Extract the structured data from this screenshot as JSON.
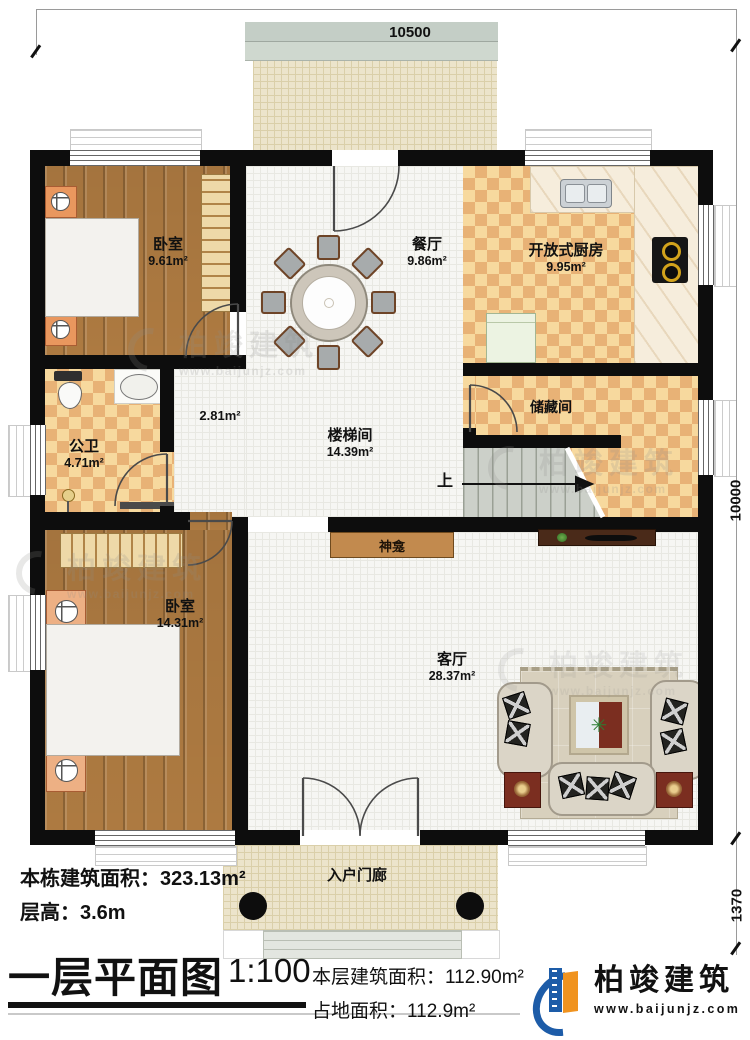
{
  "dimensions": {
    "top": "10500",
    "right_upper": "10000",
    "right_lower": "1370"
  },
  "rooms": {
    "bedroom1": {
      "name": "卧室",
      "area": "9.61m²"
    },
    "dining": {
      "name": "餐厅",
      "area": "9.86m²"
    },
    "kitchen": {
      "name": "开放式厨房",
      "area": "9.95m²"
    },
    "storage": {
      "name": "储藏间"
    },
    "hallway": {
      "area": "2.81m²"
    },
    "bathroom": {
      "name": "公卫",
      "area": "4.71m²"
    },
    "stairwell": {
      "name": "楼梯间",
      "area": "14.39m²"
    },
    "bedroom2": {
      "name": "卧室",
      "area": "14.31m²"
    },
    "living": {
      "name": "客厅",
      "area": "28.37m²"
    },
    "porch": {
      "name": "入户门廊"
    },
    "shrine": {
      "name": "神龛"
    },
    "stairs": {
      "up_label": "上"
    }
  },
  "notes": {
    "total_area": "本栋建筑面积：323.13m²",
    "floor_height": "层高：3.6m"
  },
  "title_block": {
    "title": "一层平面图",
    "scale": "1:100",
    "floor_area_label": "本层建筑面积：",
    "floor_area_value": "112.90m²",
    "land_area_label": "占地面积：",
    "land_area_value": "112.9m²"
  },
  "brand": {
    "name": "柏竣建筑",
    "website": "www.baijunjz.com"
  },
  "watermark": {
    "name": "柏竣建筑",
    "website": "www.baijunjz.com"
  },
  "colors": {
    "wall": "#0d0d0d",
    "wood_floor": "#ad7a41",
    "tile_light": "#f7d99e",
    "tile_dark": "#e8b276",
    "bed_blue": "#5cb0cc",
    "brand_blue": "#1d5ca8",
    "brand_orange": "#f0931f"
  }
}
